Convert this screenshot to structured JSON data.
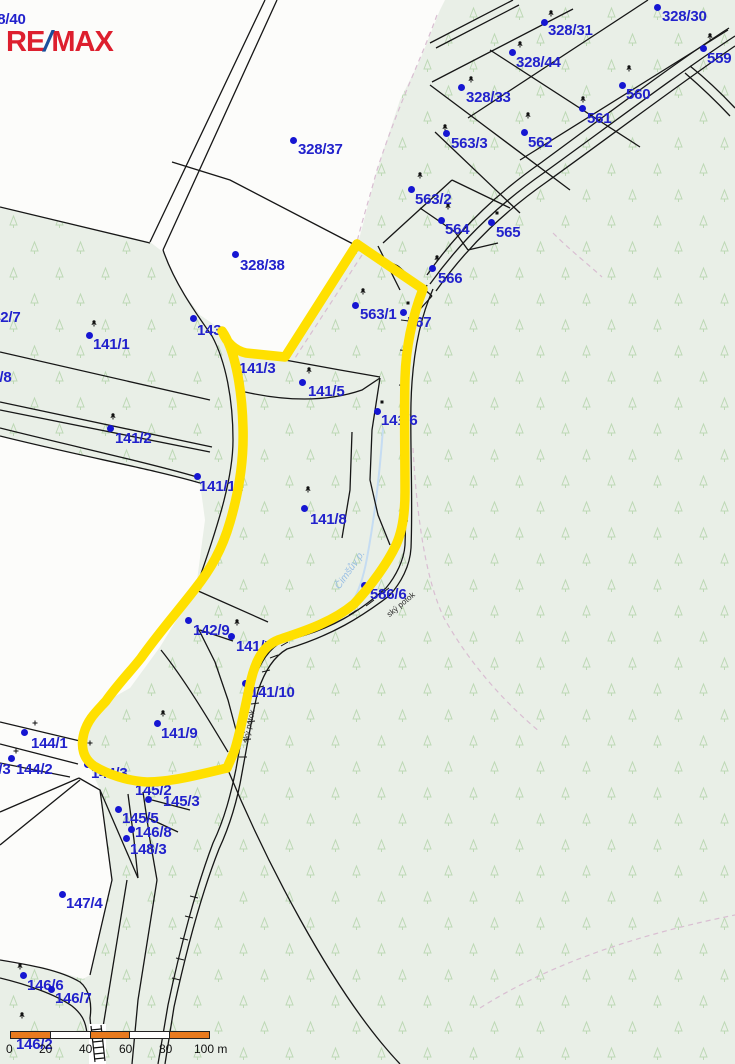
{
  "logo": {
    "re": "RE",
    "slash": "/",
    "max": "MAX",
    "red": "#dd1f2e",
    "blue": "#1a4f9c"
  },
  "map": {
    "highlight_color": "#ffe000",
    "label_color": "#2222cc",
    "dot_color": "#1616d2",
    "stream_label": {
      "text": "Čimšův p.",
      "x": 333,
      "y": 585,
      "rot": -55,
      "color": "#9abfe4"
    },
    "watercourse_inline_labels": [
      {
        "text": "ský potok",
        "x": 385,
        "y": 612,
        "rot": -40
      },
      {
        "text": "ský potok",
        "x": 241,
        "y": 742,
        "rot": -78
      }
    ],
    "parcel_labels": [
      {
        "text": "328/40",
        "x": -19,
        "y": 13,
        "dot": null
      },
      {
        "text": "328/31",
        "x": 548,
        "y": 24,
        "dot": [
          544,
          22
        ]
      },
      {
        "text": "328/30",
        "x": 662,
        "y": 10,
        "dot": [
          657,
          7
        ]
      },
      {
        "text": "559",
        "x": 707,
        "y": 52,
        "dot": [
          703,
          48
        ]
      },
      {
        "text": "328/44",
        "x": 516,
        "y": 56,
        "dot": [
          512,
          52
        ]
      },
      {
        "text": "328/33",
        "x": 466,
        "y": 91,
        "dot": [
          461,
          87
        ]
      },
      {
        "text": "560",
        "x": 626,
        "y": 88,
        "dot": [
          622,
          85
        ]
      },
      {
        "text": "561",
        "x": 587,
        "y": 112,
        "dot": [
          582,
          108
        ]
      },
      {
        "text": "562",
        "x": 528,
        "y": 136,
        "dot": [
          524,
          132
        ]
      },
      {
        "text": "563/3",
        "x": 451,
        "y": 137,
        "dot": [
          446,
          133
        ]
      },
      {
        "text": "328/37",
        "x": 298,
        "y": 143,
        "dot": [
          293,
          140
        ]
      },
      {
        "text": "563/2",
        "x": 415,
        "y": 193,
        "dot": [
          411,
          189
        ]
      },
      {
        "text": "564",
        "x": 445,
        "y": 223,
        "dot": [
          441,
          220
        ]
      },
      {
        "text": "565",
        "x": 496,
        "y": 226,
        "dot": [
          491,
          222
        ]
      },
      {
        "text": "566",
        "x": 438,
        "y": 272,
        "dot": [
          432,
          268
        ]
      },
      {
        "text": "328/38",
        "x": 240,
        "y": 259,
        "dot": [
          235,
          254
        ]
      },
      {
        "text": "563/1",
        "x": 360,
        "y": 308,
        "dot": [
          355,
          305
        ]
      },
      {
        "text": "567",
        "x": 407,
        "y": 316,
        "dot": [
          403,
          312
        ]
      },
      {
        "text": "142/7",
        "x": -16,
        "y": 311,
        "dot": null
      },
      {
        "text": "141/1",
        "x": 93,
        "y": 338,
        "dot": [
          89,
          335
        ]
      },
      {
        "text": "143",
        "x": 197,
        "y": 324,
        "dot": [
          193,
          318
        ]
      },
      {
        "text": "141/3",
        "x": 239,
        "y": 362,
        "dot": [
          234,
          356
        ]
      },
      {
        "text": "142/8",
        "x": -25,
        "y": 371,
        "dot": null
      },
      {
        "text": "141/5",
        "x": 308,
        "y": 385,
        "dot": [
          302,
          382
        ]
      },
      {
        "text": "141/2",
        "x": 115,
        "y": 432,
        "dot": [
          110,
          428
        ]
      },
      {
        "text": "141/6",
        "x": 381,
        "y": 414,
        "dot": [
          377,
          411
        ]
      },
      {
        "text": "141/11",
        "x": 199,
        "y": 480,
        "dot": [
          197,
          476
        ]
      },
      {
        "text": "141/8",
        "x": 310,
        "y": 513,
        "dot": [
          304,
          508
        ]
      },
      {
        "text": "586/6",
        "x": 370,
        "y": 588,
        "dot": [
          364,
          585
        ]
      },
      {
        "text": "142/9",
        "x": 193,
        "y": 624,
        "dot": [
          188,
          620
        ]
      },
      {
        "text": "141/7",
        "x": 236,
        "y": 640,
        "dot": [
          231,
          636
        ]
      },
      {
        "text": "141/10",
        "x": 250,
        "y": 686,
        "dot": [
          245,
          683
        ]
      },
      {
        "text": "141/9",
        "x": 161,
        "y": 727,
        "dot": [
          157,
          723
        ]
      },
      {
        "text": "144/1",
        "x": 31,
        "y": 737,
        "dot": [
          24,
          732
        ]
      },
      {
        "text": "144/3",
        "x": -26,
        "y": 763,
        "dot": null
      },
      {
        "text": "144/2",
        "x": 16,
        "y": 763,
        "dot": [
          11,
          758
        ]
      },
      {
        "text": "144/3",
        "x": 91,
        "y": 767,
        "dot": [
          87,
          764
        ]
      },
      {
        "text": "145/2",
        "x": 135,
        "y": 784,
        "dot": [
          130,
          780
        ]
      },
      {
        "text": "145/3",
        "x": 163,
        "y": 795,
        "dot": [
          148,
          799
        ]
      },
      {
        "text": "145/5",
        "x": 122,
        "y": 812,
        "dot": [
          118,
          809
        ]
      },
      {
        "text": "146/8",
        "x": 135,
        "y": 826,
        "dot": [
          131,
          829
        ]
      },
      {
        "text": "148/3",
        "x": 130,
        "y": 843,
        "dot": [
          126,
          838
        ]
      },
      {
        "text": "147/4",
        "x": 66,
        "y": 897,
        "dot": [
          62,
          894
        ]
      },
      {
        "text": "146/6",
        "x": 27,
        "y": 979,
        "dot": [
          23,
          975
        ]
      },
      {
        "text": "146/7",
        "x": 55,
        "y": 992,
        "dot": [
          51,
          989
        ]
      },
      {
        "text": "146/2",
        "x": 16,
        "y": 1038,
        "dot": null
      }
    ]
  },
  "scalebar": {
    "labels": [
      "0",
      "20",
      "40",
      "60",
      "80",
      "100 m"
    ],
    "orange": "#e87a1e"
  }
}
